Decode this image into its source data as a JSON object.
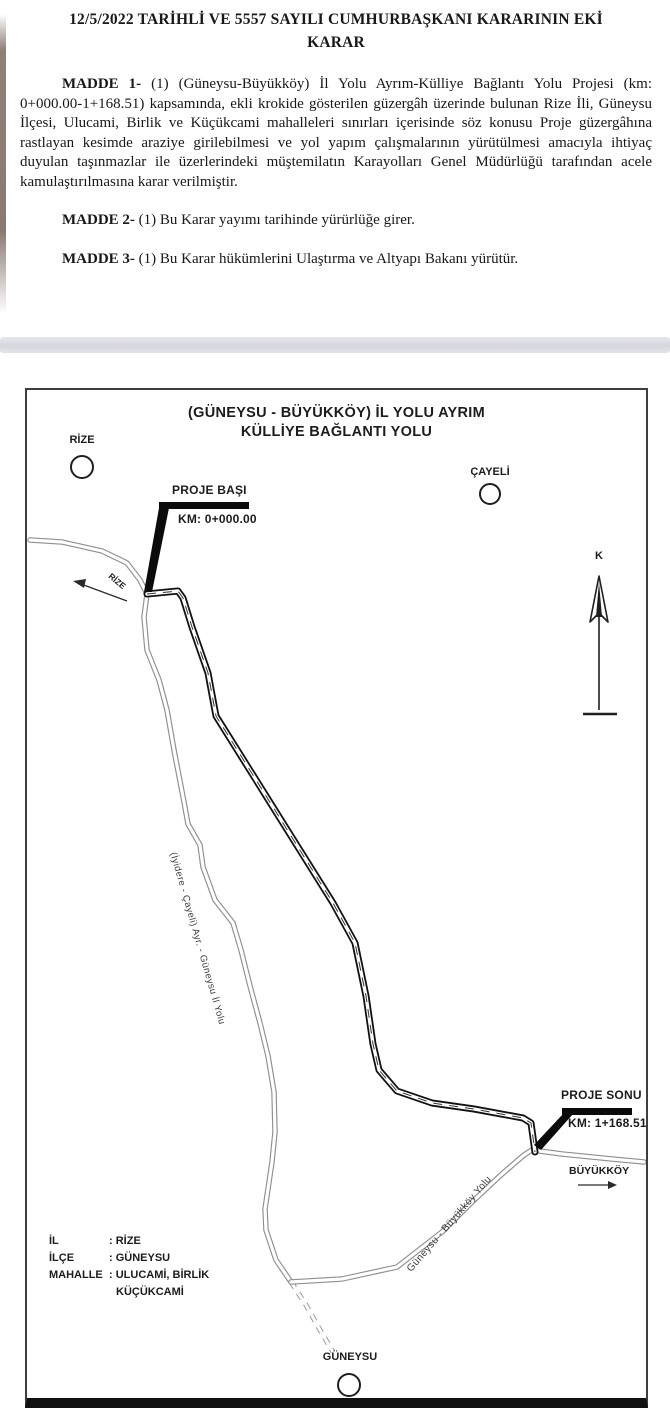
{
  "document": {
    "title_line1": "12/5/2022 TARİHLİ VE 5557 SAYILI CUMHURBAŞKANI KARARININ EKİ",
    "title_line2": "KARAR",
    "articles": [
      {
        "label": "MADDE 1-",
        "text": " (1) (Güneysu-Büyükköy) İl Yolu Ayrım-Külliye Bağlantı Yolu Projesi (km: 0+000.00-1+168.51) kapsamında, ekli krokide gösterilen güzergâh üzerinde bulunan Rize İli, Güneysu İlçesi, Ulucami, Birlik ve Küçükcami mahalleleri sınırları içerisinde söz konusu Proje güzergâhına rastlayan kesimde araziye girilebilmesi ve yol yapım çalışmalarının yürütülmesi amacıyla ihtiyaç duyulan taşınmazlar ile üzerlerindeki müştemilatın Karayolları Genel Müdürlüğü tarafından acele kamulaştırılmasına karar verilmiştir."
      },
      {
        "label": "MADDE 2-",
        "text": " (1) Bu Karar yayımı tarihinde yürürlüğe girer."
      },
      {
        "label": "MADDE 3-",
        "text": " (1) Bu Karar hükümlerini Ulaştırma ve Altyapı Bakanı yürütür."
      }
    ]
  },
  "map": {
    "title_line1": "(GÜNEYSU - BÜYÜKKÖY) İL YOLU AYRIM",
    "title_line2": "KÜLLİYE BAĞLANTI YOLU",
    "north_label": "K",
    "places": {
      "rize": "RİZE",
      "cayeli": "ÇAYELİ",
      "guneysu": "GÜNEYSU",
      "buyukkoy": "BÜYÜKKÖY"
    },
    "project_start": {
      "label": "PROJE BAŞI",
      "km": "KM: 0+000.00"
    },
    "project_end": {
      "label": "PROJE SONU",
      "km": "KM: 1+168.51"
    },
    "road_labels": {
      "rize_direction": "RİZE",
      "left_road": "(İyidere - Çayeli) Ayr. - Güneysu İl Yolu",
      "bottom_road": "Güneysu - Büyükköy Yolu"
    },
    "info": {
      "rows": [
        {
          "label": "İL",
          "value": ": RİZE"
        },
        {
          "label": "İLÇE",
          "value": ": GÜNEYSU"
        },
        {
          "label": "MAHALLE",
          "value": ": ULUCAMİ, BİRLİK"
        },
        {
          "label": "",
          "value": "KÜÇÜKCAMİ"
        }
      ]
    },
    "colors": {
      "ink": "#1c1c1c",
      "road_thin": "#8f8f8f",
      "road_project": "#111111",
      "separator_band": "#d6d6dd",
      "scan_edge": "#7c6a62"
    }
  }
}
